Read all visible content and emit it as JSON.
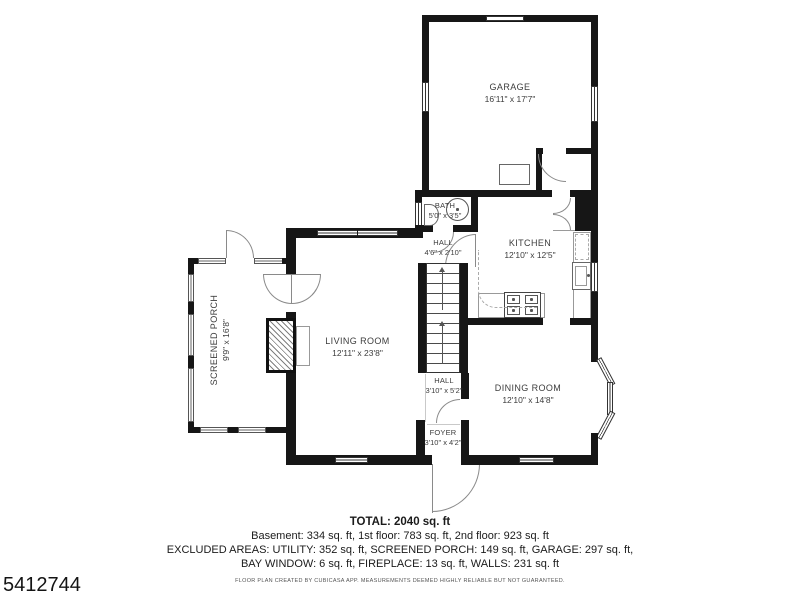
{
  "rooms": {
    "garage": {
      "name": "GARAGE",
      "dims": "16'11\" x 17'7\""
    },
    "bath": {
      "name": "BATH",
      "dims": "5'0\" x 3'5\""
    },
    "hall_upper": {
      "name": "HALL",
      "dims": "4'6\" x 2'10\""
    },
    "kitchen": {
      "name": "KITCHEN",
      "dims": "12'10\" x 12'5\""
    },
    "living_room": {
      "name": "LIVING ROOM",
      "dims": "12'11\" x 23'8\""
    },
    "dining_room": {
      "name": "DINING ROOM",
      "dims": "12'10\" x 14'8\""
    },
    "screened_porch": {
      "name": "SCREENED PORCH",
      "dims": "9'9\" x 16'8\""
    },
    "hall_lower": {
      "name": "HALL",
      "dims": "3'10\" x 5'2\""
    },
    "foyer": {
      "name": "FOYER",
      "dims": "3'10\" x 4'2\""
    }
  },
  "summary": {
    "total": "TOTAL: 2040 sq. ft",
    "floors": "Basement: 334 sq. ft, 1st floor: 783 sq. ft, 2nd floor: 923 sq. ft",
    "excluded1": "EXCLUDED AREAS: UTILITY: 352 sq. ft, SCREENED PORCH: 149 sq. ft, GARAGE: 297 sq. ft,",
    "excluded2": "BAY WINDOW: 6 sq. ft, FIREPLACE: 13 sq. ft, WALLS: 231 sq. ft",
    "disclaimer": "FLOOR PLAN CREATED BY CUBICASA APP. MEASUREMENTS DEEMED HIGHLY RELIABLE BUT NOT GUARANTEED."
  },
  "watermark": "5412744"
}
